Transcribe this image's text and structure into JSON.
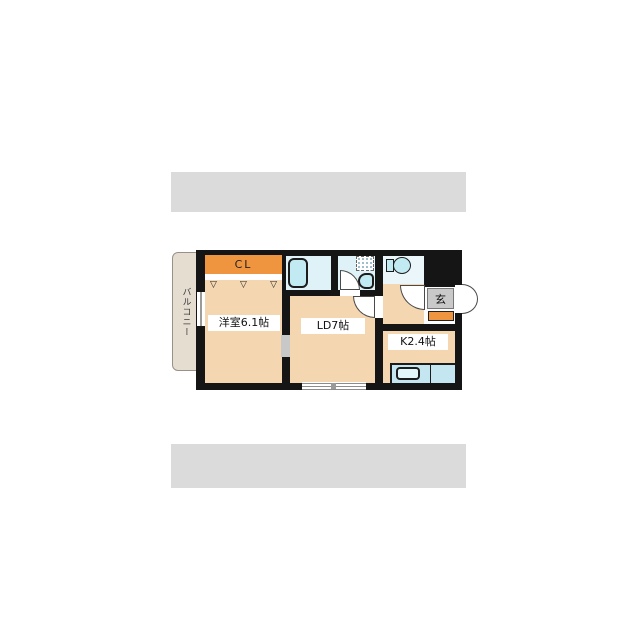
{
  "rooms": {
    "balcony": {
      "label": "バルコニー"
    },
    "closet": {
      "label": "CL"
    },
    "western_room": {
      "label": "洋室6.1帖"
    },
    "living_dining": {
      "label": "LD7帖"
    },
    "kitchen": {
      "label": "K2.4帖"
    },
    "entrance": {
      "label": "玄"
    }
  },
  "icons": {
    "hanger": "▽"
  },
  "colors": {
    "wall": "#151515",
    "room_floor": "#f4d7b1",
    "closet_orange": "#f0953f",
    "balcony_fill": "#e6ddd1",
    "wet_floor": "#dff2f8",
    "fixture_cyan": "#c2eaf2",
    "counter_blue": "#c3e6f0",
    "genkan_gray": "#c9c9c9",
    "band_gray": "#dbdbdb"
  }
}
